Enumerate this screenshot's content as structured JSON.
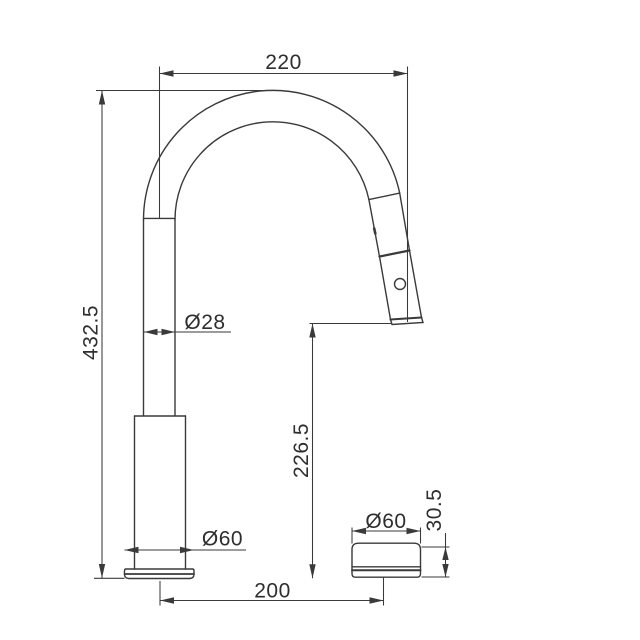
{
  "drawing": {
    "background_color": "#ffffff",
    "line_color": "#3a3a3a",
    "text_color": "#2e2e2e",
    "dims": {
      "spout_reach": "220",
      "overall_height": "432.5",
      "spout_tube_diameter": "Ø28",
      "outlet_height": "226.5",
      "base_diameter": "Ø60",
      "center_distance": "200",
      "handle_diameter": "Ø60",
      "handle_height": "30.5"
    }
  }
}
